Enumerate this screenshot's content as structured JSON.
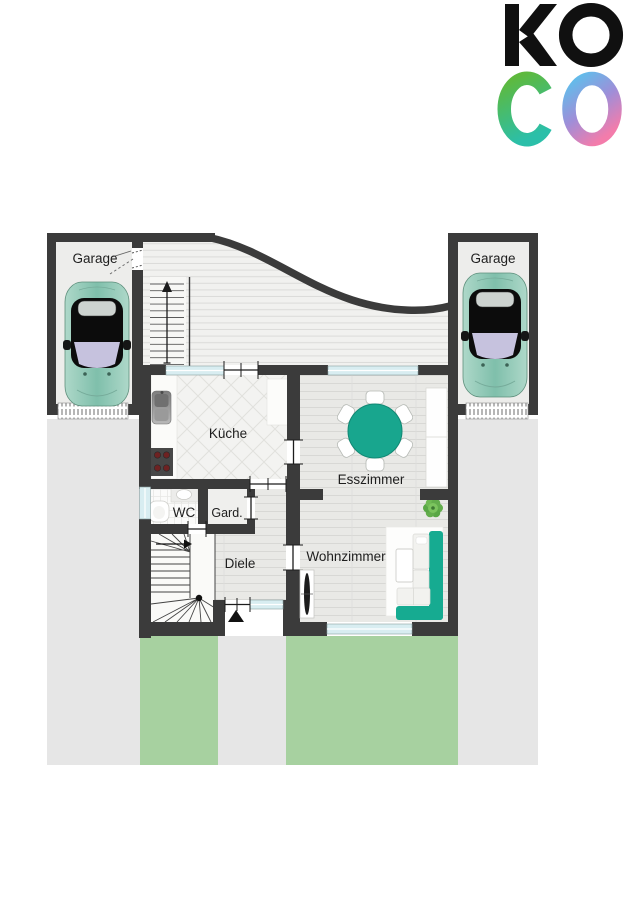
{
  "logo": {
    "line1": "KO",
    "letter_c": "C",
    "letter_o": "O",
    "color_black": "#101010",
    "gradient_c": [
      "#5eb93d",
      "#2bbfa9"
    ],
    "gradient_o": [
      "#63bbea",
      "#9f8ed8",
      "#f37cab"
    ]
  },
  "plan": {
    "labels": {
      "garage_left": "Garage",
      "garage_right": "Garage",
      "kitchen": "Küche",
      "dining_room": "Esszimmer",
      "wc": "WC",
      "wardrobe": "Gard.",
      "hallway": "Diele",
      "living_room": "Wohnzimmer"
    },
    "colors": {
      "wall": "#3b3b3b",
      "site_paving": "#e6e6e6",
      "lawn": "#a7d1a0",
      "window": "#d8edf1",
      "accent_teal": "#18a68e",
      "sofa_teal": "#16ab91",
      "car_body": "#8fc6b4",
      "deck": "#f1f1ef",
      "wood_floor": "#e9e9e7"
    }
  }
}
